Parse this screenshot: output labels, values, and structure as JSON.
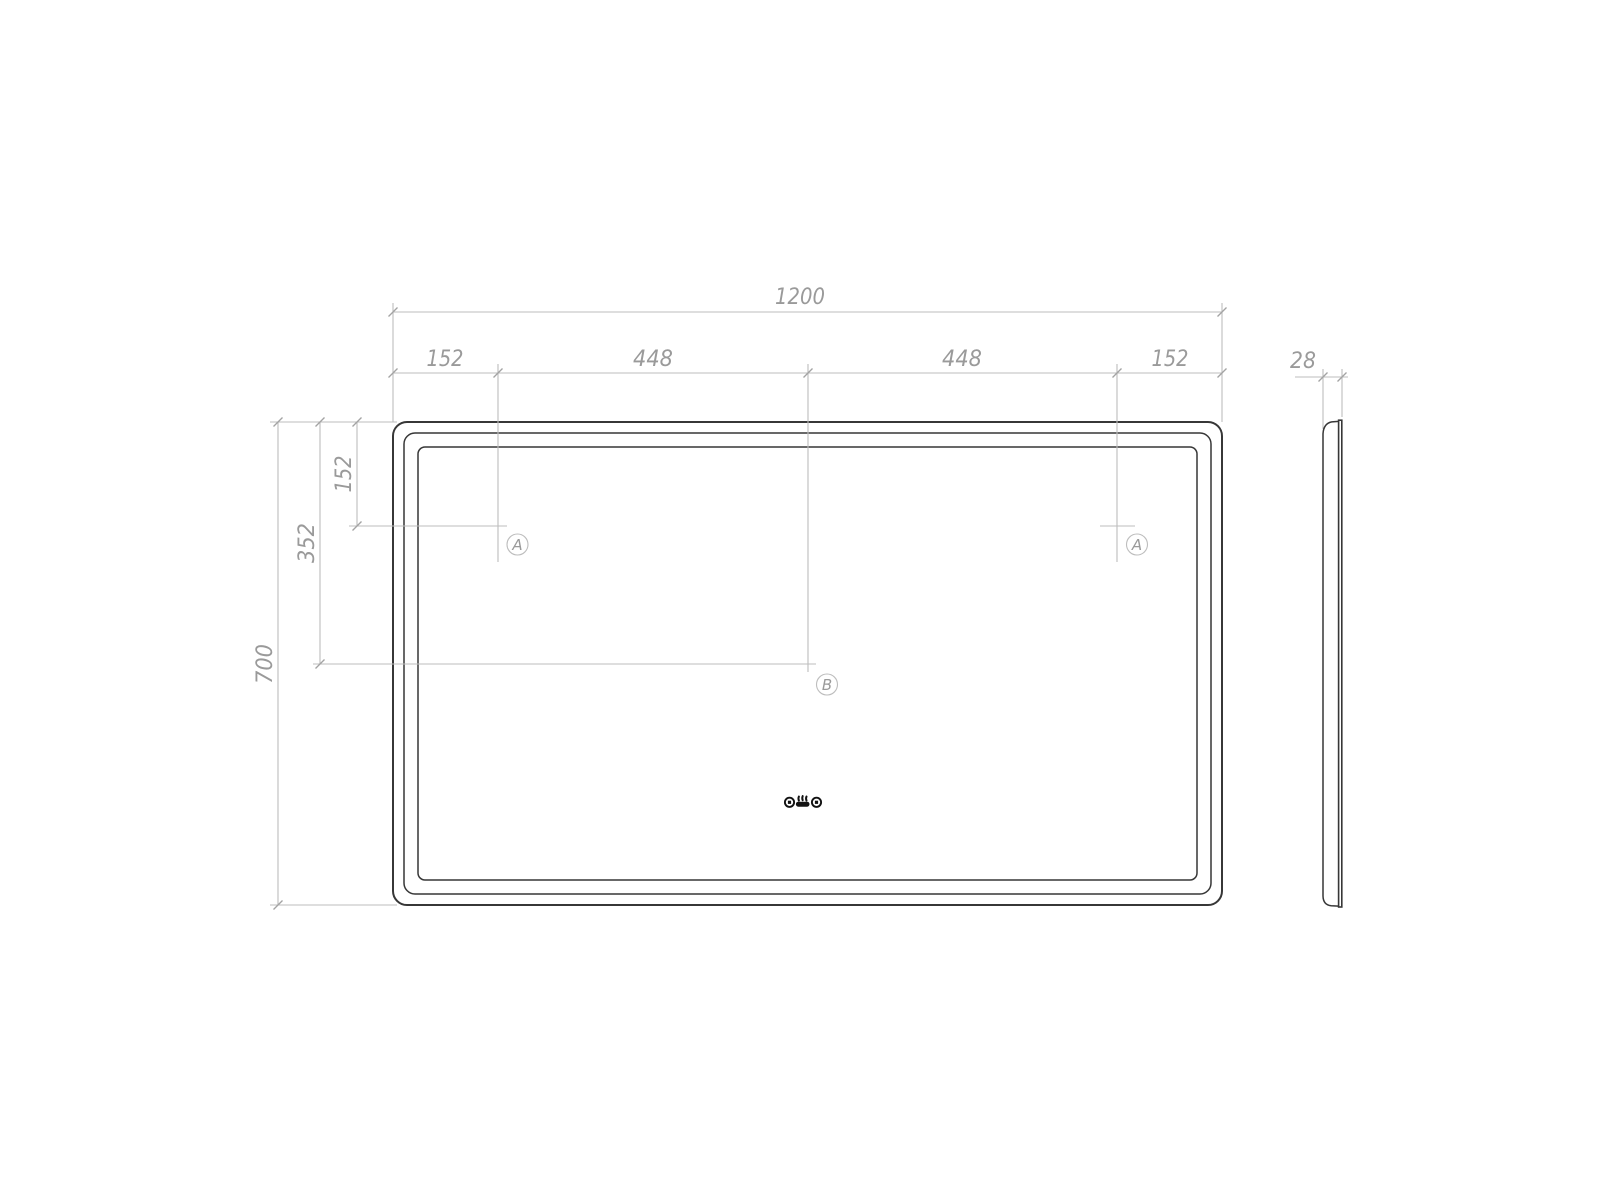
{
  "drawing": {
    "kind": "technical-dimension-drawing",
    "subject": "led-mirror-front-and-side-view"
  },
  "front_view": {
    "dim_total_width": "1200",
    "dim_sub_widths": [
      "152",
      "448",
      "448",
      "152"
    ],
    "dim_height": "700",
    "dim_a_vertical_offset": "152",
    "dim_b_vertical_offset": "352",
    "markers": {
      "a_left": "A",
      "a_right": "A",
      "b": "B"
    }
  },
  "side_view": {
    "dim_thickness": "28"
  },
  "icons": [
    "touch-sensor-button",
    "defogger",
    "touch-sensor-button"
  ],
  "colors": {
    "background": "#ffffff",
    "object_line": "#373737",
    "dimension_line": "#bdbdbd",
    "dimension_tick": "#a3a3a3",
    "dimension_text": "#9a9a9a",
    "icon": "#121212"
  }
}
